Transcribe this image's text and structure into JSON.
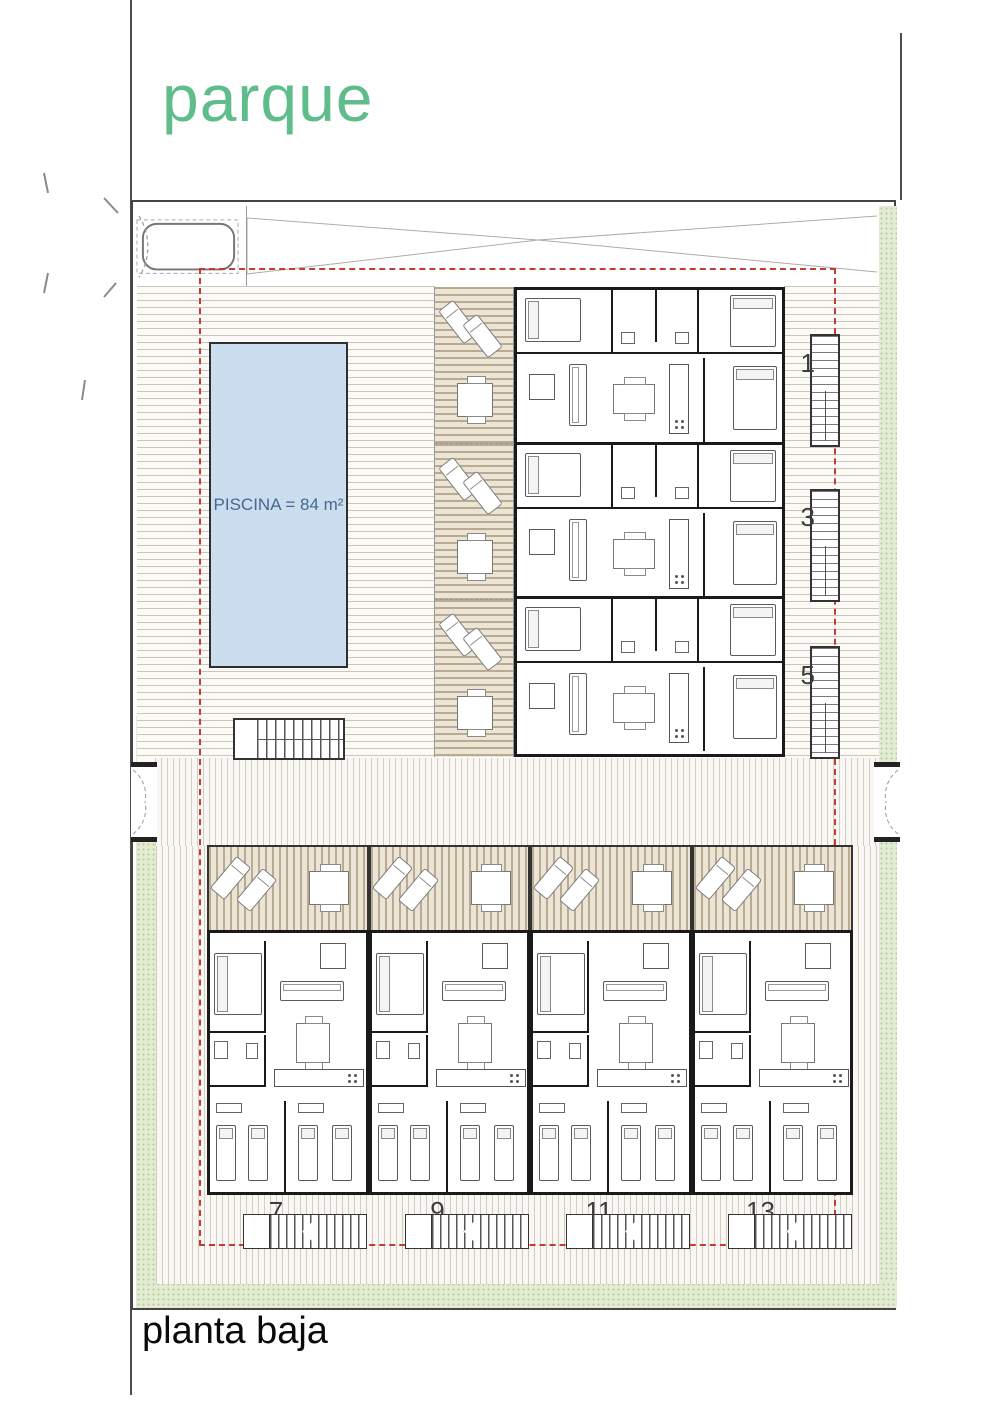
{
  "labels": {
    "park": "parque",
    "floor": "planta baja"
  },
  "pool": {
    "label": "PISCINA = 84 m²",
    "area_m2": 84
  },
  "upper_units": [
    {
      "number": "1"
    },
    {
      "number": "3"
    },
    {
      "number": "5"
    }
  ],
  "lower_units": [
    {
      "number": "7"
    },
    {
      "number": "9"
    },
    {
      "number": "11"
    },
    {
      "number": "13"
    }
  ],
  "colors": {
    "park_text": "#5ebd8a",
    "pool_fill": "#cadeef",
    "pool_text": "#48688c",
    "boundary_red": "#c43c30",
    "green_band": "#e3ecd3",
    "wall": "#1a1a1a"
  }
}
